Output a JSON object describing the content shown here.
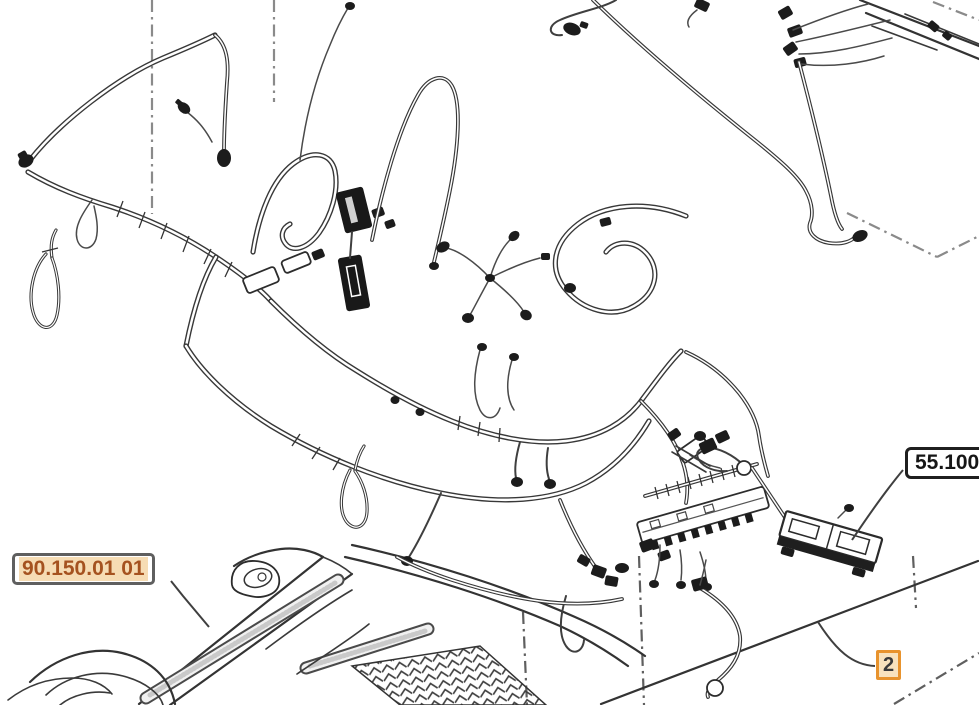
{
  "page": {
    "width": 979,
    "height": 705,
    "background": "#ffffff"
  },
  "diagram": {
    "description": "Exploded line-art parts diagram of a cab main wiring harness",
    "callouts": {
      "hood_section_ref": {
        "text": "90.150.01 01"
      },
      "harness_section_ref": {
        "text": "55.100"
      },
      "item_number": {
        "text": "2"
      }
    },
    "colors": {
      "line_art": "#3a3a3a",
      "boundary_line": "#8a8a8a",
      "ref_link_text": "#a5521f",
      "ref_link_highlight": "#f6dcb4",
      "ref_border_gray": "#5f5f5f",
      "ref_border_dark": "#1f1f1f",
      "item_box_border": "#e8932d",
      "item_box_bg": "#f8e2bd",
      "item_text": "#3a3a3a"
    }
  }
}
